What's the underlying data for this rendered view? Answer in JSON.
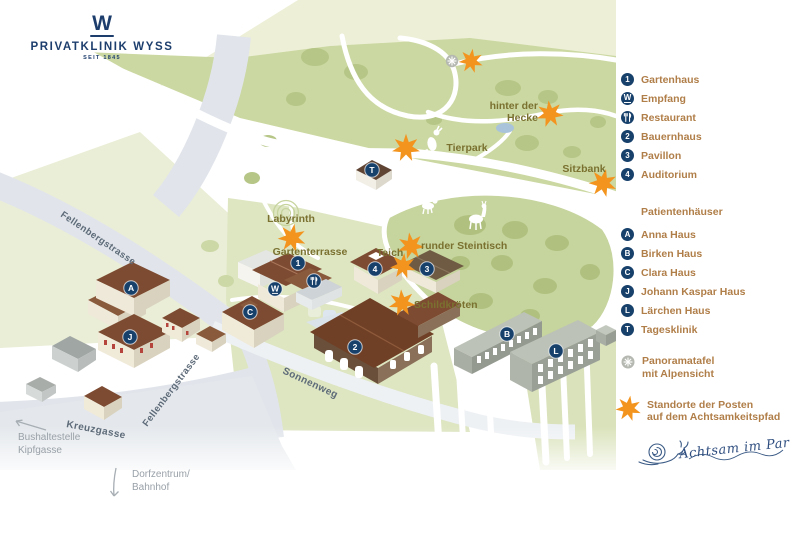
{
  "logo": {
    "letter": "W",
    "name": "PRIVATKLINIK WYSS",
    "since": "SEIT 1845"
  },
  "colors": {
    "navy": "#17406b",
    "orange": "#f3941e",
    "legend_text": "#b07e48",
    "map_label": "#7a7130",
    "road_label": "#5d6a78",
    "muted_label": "#99a1a8",
    "park_green": "#cbd8a1",
    "tree_green": "#b0c17f",
    "road_grey": "#e1e5eb"
  },
  "legend": {
    "buildings": [
      {
        "badge": "1",
        "label": "Gartenhaus"
      },
      {
        "badge": "W",
        "label": "Empfang"
      },
      {
        "badge": "",
        "label": "Restaurant",
        "icon": "fork-knife-icon"
      },
      {
        "badge": "2",
        "label": "Bauernhaus"
      },
      {
        "badge": "3",
        "label": "Pavillon"
      },
      {
        "badge": "4",
        "label": "Auditorium"
      }
    ],
    "patients_header": "Patientenhäuser",
    "patients": [
      {
        "badge": "A",
        "label": "Anna Haus"
      },
      {
        "badge": "B",
        "label": "Birken Haus"
      },
      {
        "badge": "C",
        "label": "Clara Haus"
      },
      {
        "badge": "J",
        "label": "Johann Kaspar Haus"
      },
      {
        "badge": "L",
        "label": "Lärchen Haus"
      },
      {
        "badge": "T",
        "label": "Tagesklinik"
      }
    ],
    "panorama": {
      "line1": "Panoramatafel",
      "line2": "mit Alpensicht"
    },
    "posts": {
      "line1": "Standorte der Posten",
      "line2": "auf dem Achtsamkeitspfad"
    },
    "slogan": "Achtsam im Park"
  },
  "map": {
    "labels": {
      "labyrinth": "Labyrinth",
      "gartenterrasse": "Gartenterrasse",
      "teich": "Teich",
      "steintisch": "runder Steintisch",
      "schildkroeten": "Schildkröten",
      "tierpark": "Tierpark",
      "sitzbank": "Sitzbank",
      "hecke1": "hinter der",
      "hecke2": "Hecke"
    },
    "roads": {
      "fellenberg1": "Fellenbergstrasse",
      "fellenberg2": "Fellenbergstrasse",
      "sonnenweg": "Sonnenweg",
      "kreuzgasse": "Kreuzgasse"
    },
    "places": {
      "bus1": "Bushaltestelle",
      "bus2": "Kipfgasse",
      "dorf1": "Dorfzentrum/",
      "dorf2": "Bahnhof"
    },
    "badges": {
      "b1": "1",
      "b2": "2",
      "b3": "3",
      "b4": "4",
      "bw": "W",
      "ba": "A",
      "bb": "B",
      "bc": "C",
      "bj": "J",
      "bl": "L",
      "bt": "T"
    }
  }
}
